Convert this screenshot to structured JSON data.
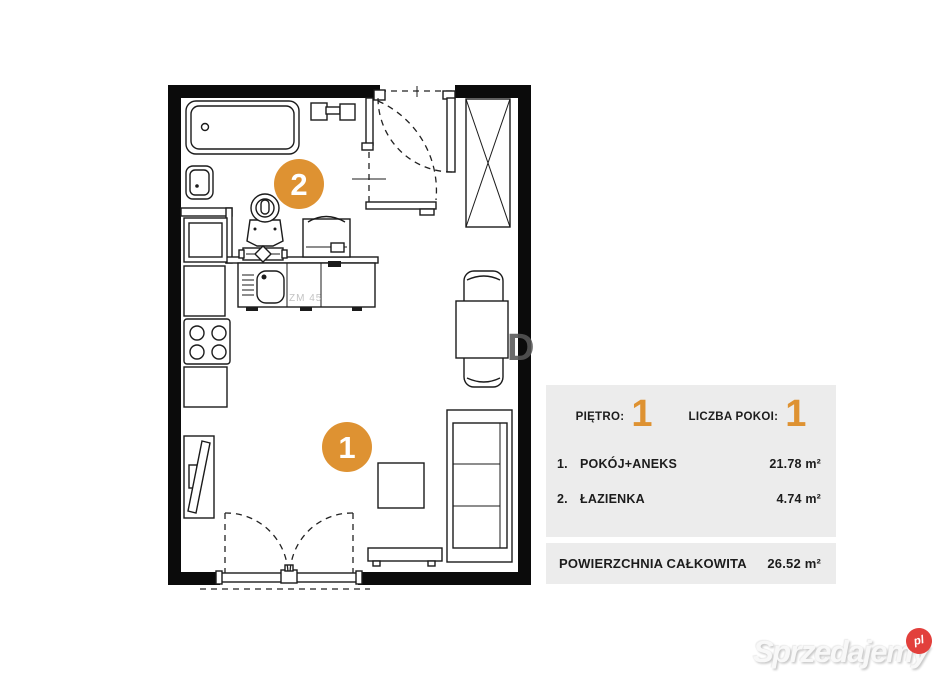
{
  "colors": {
    "accent": "#DE9232",
    "wall": "#0B0B0B",
    "panel_bg": "#ECECEC",
    "badge_red": "#E2403C",
    "watermark_text": "#F8F8F8",
    "text": "#1C1C1C"
  },
  "plan": {
    "labels": {
      "living": "1",
      "bathroom": "2"
    },
    "dishwasher_label": "ZM 45",
    "watermark_fragment": "D"
  },
  "info_panel": {
    "floor_label": "PIĘTRO:",
    "floor_value": "1",
    "rooms_label": "LICZBA POKOI:",
    "rooms_value": "1",
    "rows": [
      {
        "index": "1.",
        "name": "POKÓJ+ANEKS",
        "area": "21.78 m²"
      },
      {
        "index": "2.",
        "name": "ŁAZIENKA",
        "area": "4.74 m²"
      }
    ],
    "total_label": "POWIERZCHNIA CAŁKOWITA",
    "total_value": "26.52 m²"
  },
  "watermark": {
    "brand": "Sprzedajemy",
    "tld": "pl"
  }
}
